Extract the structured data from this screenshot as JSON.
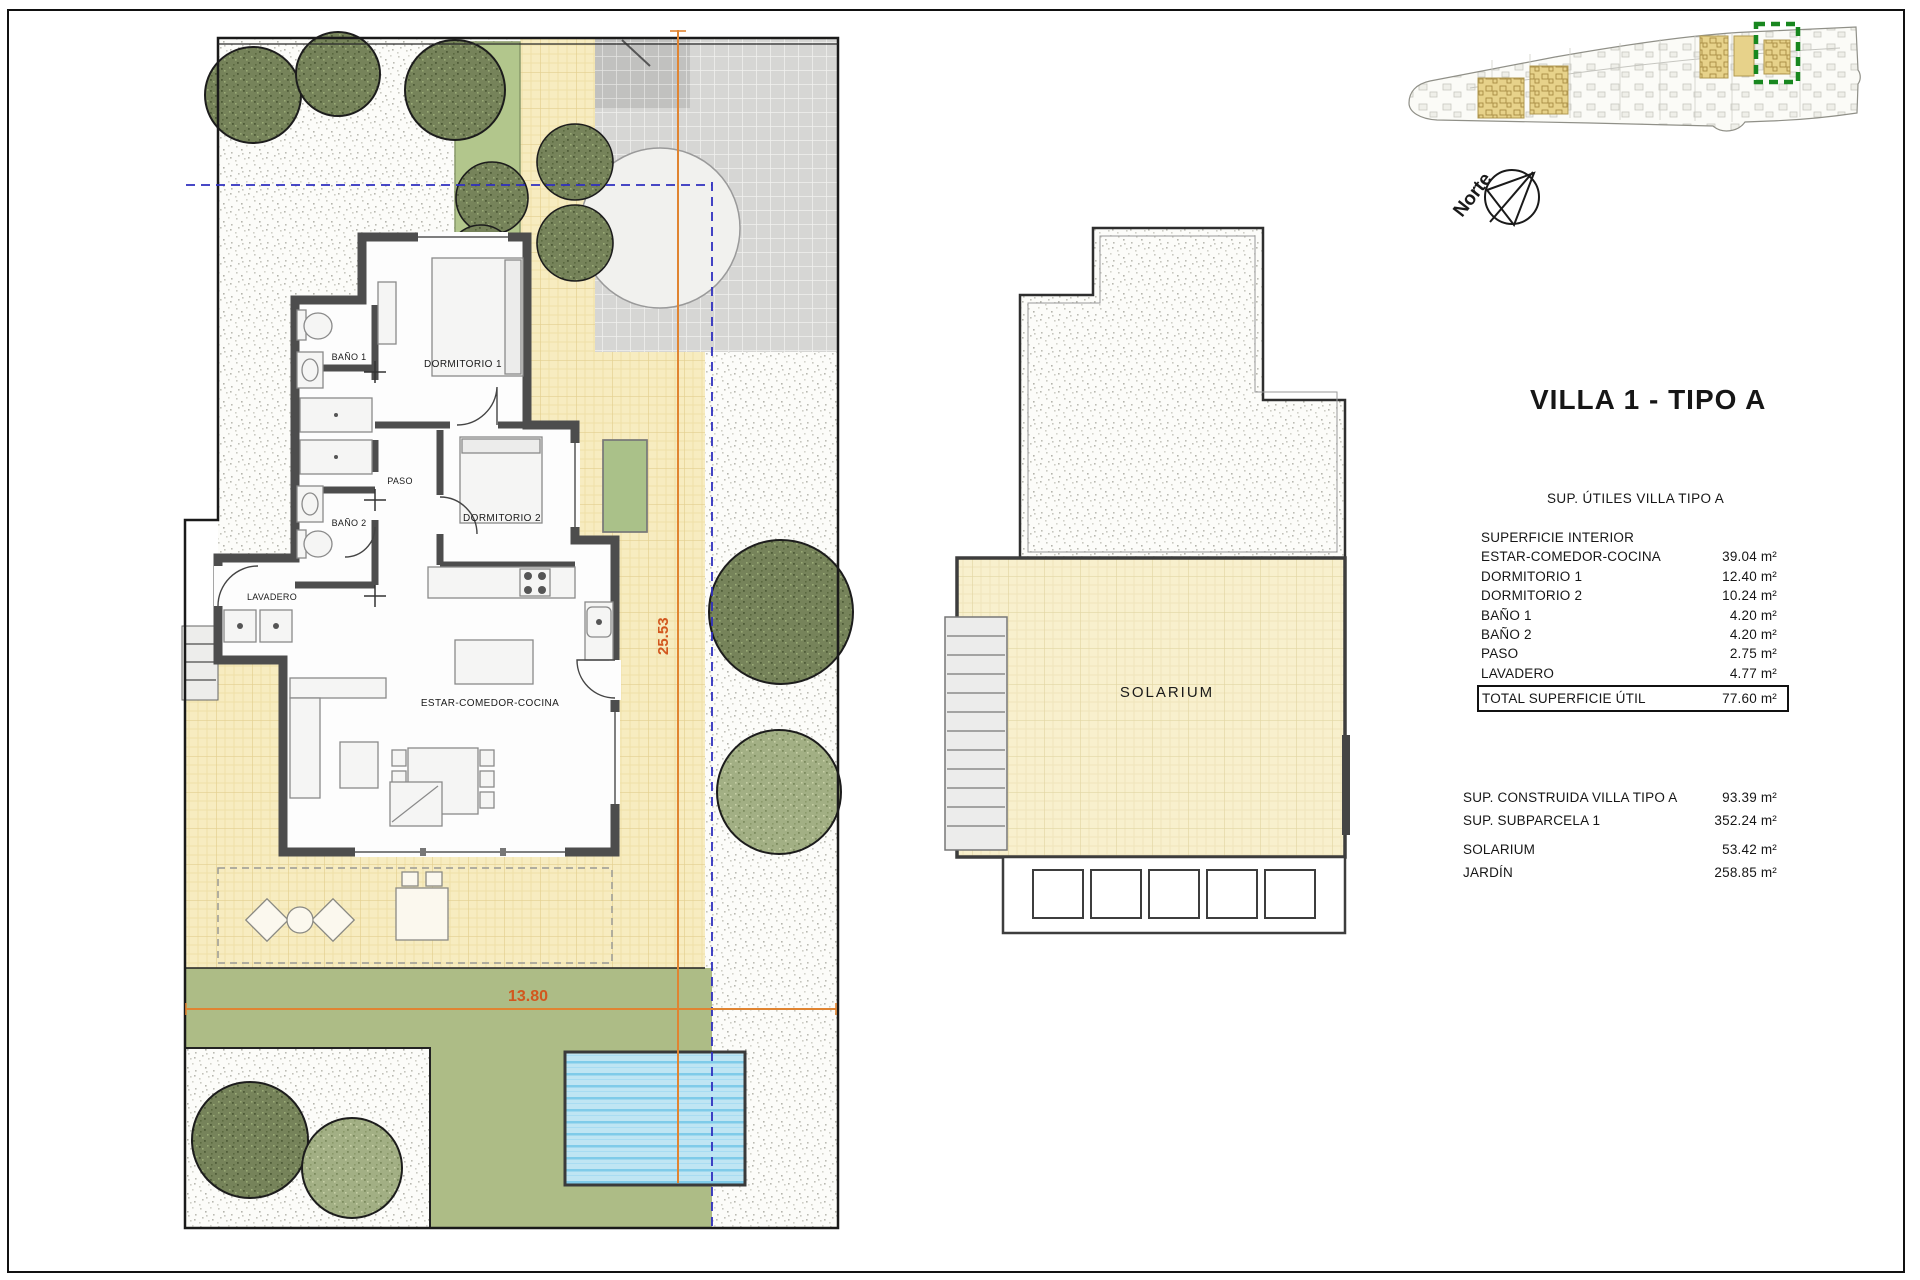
{
  "title": "VILLA 1 - TIPO A",
  "compass": {
    "label": "Norte"
  },
  "plan": {
    "rooms": {
      "bano1": "BAÑO 1",
      "dormitorio1": "DORMITORIO 1",
      "paso": "PASO",
      "bano2": "BAÑO 2",
      "dormitorio2": "DORMITORIO 2",
      "lavadero": "LAVADERO",
      "estar": "ESTAR-COMEDOR-COCINA"
    },
    "dimensions": {
      "height": "25.53",
      "width": "13.80"
    }
  },
  "solarium_plan": {
    "label": "SOLARIUM"
  },
  "tables": {
    "utiles": {
      "title": "SUP. ÚTILES VILLA TIPO A",
      "section": "SUPERFICIE INTERIOR",
      "rows": [
        {
          "label": "ESTAR-COMEDOR-COCINA",
          "value": "39.04 m²"
        },
        {
          "label": "DORMITORIO 1",
          "value": "12.40 m²"
        },
        {
          "label": "DORMITORIO 2",
          "value": "10.24 m²"
        },
        {
          "label": "BAÑO 1",
          "value": "4.20 m²"
        },
        {
          "label": "BAÑO 2",
          "value": "4.20 m²"
        },
        {
          "label": "PASO",
          "value": "2.75 m²"
        },
        {
          "label": "LAVADERO",
          "value": "4.77 m²"
        }
      ],
      "total": {
        "label": "TOTAL SUPERFICIE ÚTIL",
        "value": "77.60 m²"
      }
    },
    "summary": {
      "rows": [
        {
          "label": "SUP. CONSTRUIDA VILLA TIPO A",
          "value": "93.39 m²"
        },
        {
          "label": "SUP. SUBPARCELA 1",
          "value": "352.24 m²"
        }
      ],
      "rows2": [
        {
          "label": "SOLARIUM",
          "value": "53.42 m²"
        },
        {
          "label": "JARDÍN",
          "value": "258.85 m²"
        }
      ]
    }
  },
  "colors": {
    "dimension_orange": "#e08431",
    "dimension_text": "#d2571e",
    "guide_blue": "#2f2fbf",
    "highlight_green": "#18871f",
    "terrace_yellow": "#f7ecc0",
    "garden_green": "#adbc86",
    "pool_blue": "#bfe5f3",
    "locator_plot_yellow": "#e7d28a"
  }
}
